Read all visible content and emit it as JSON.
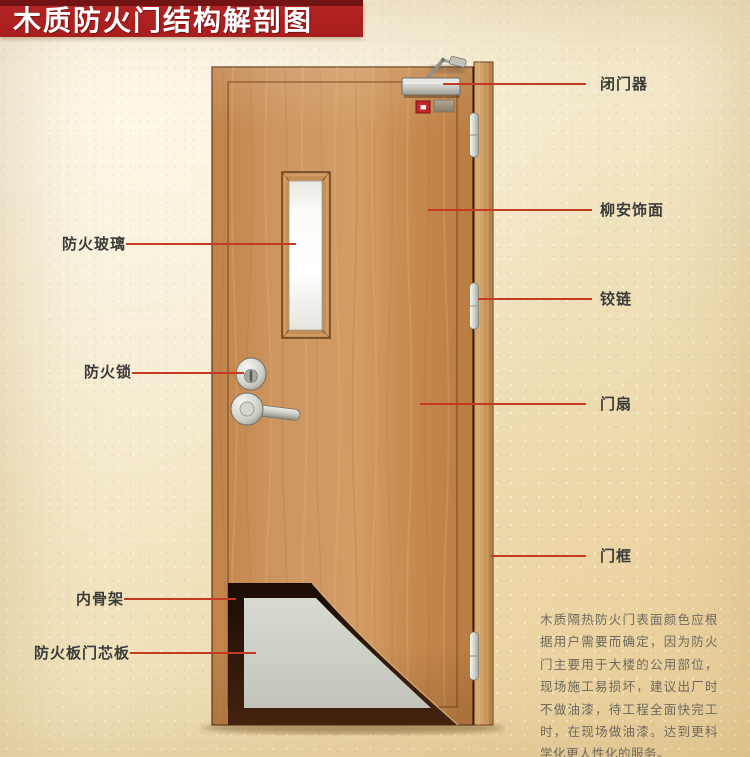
{
  "title": {
    "text": "木质防火门结构解剖图"
  },
  "annotations": {
    "left": [
      {
        "id": "fire-glass",
        "label": "防火玻璃"
      },
      {
        "id": "fire-lock",
        "label": "防火锁"
      },
      {
        "id": "inner-skeleton",
        "label": "内骨架"
      },
      {
        "id": "fire-board-core",
        "label": "防火板门芯板"
      }
    ],
    "right": [
      {
        "id": "door-closer",
        "label": "闭门器"
      },
      {
        "id": "lauan-veneer",
        "label": "柳安饰面"
      },
      {
        "id": "hinge",
        "label": "铰链"
      },
      {
        "id": "door-leaf",
        "label": "门扇"
      },
      {
        "id": "door-frame",
        "label": "门框"
      }
    ]
  },
  "description": {
    "text": "木质隔热防火门表面颜色应根据用户需要而确定，因为防火门主要用于大楼的公用部位，现场施工易损坏，建议出厂时不做油漆，待工程全面快完工时，在现场做油漆。达到更科学化更人性化的服务。"
  },
  "colors": {
    "banner": "#a81d1d",
    "banner_edge": "#731414",
    "leader_line": "#c53a22",
    "label_text": "#3b3b38",
    "description_text": "#6e695e",
    "door_wood": "#cb9158",
    "door_frame_wood": "#cfa065",
    "core_board": "#ccd0c7",
    "inner_skeleton": "#2a140a",
    "glass": "#ffffff",
    "hardware_metal": "#cfcfc8",
    "indicator_red": "#c1272a",
    "background": "#f2e6c6"
  }
}
